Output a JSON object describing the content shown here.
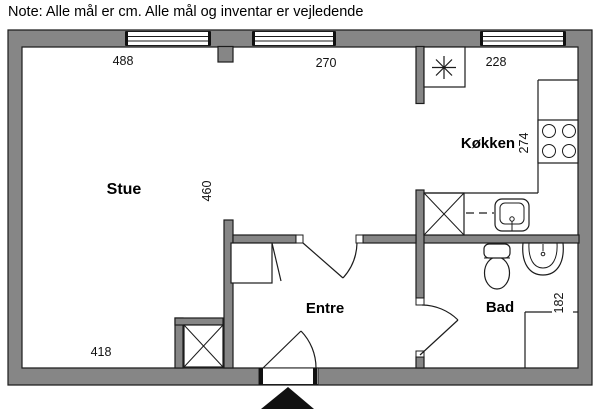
{
  "note": "Note: Alle mål er cm. Alle mål og inventar er vejledende",
  "rooms": {
    "stue": "Stue",
    "kokken": "Køkken",
    "entre": "Entre",
    "bad": "Bad"
  },
  "dimensions_cm": {
    "stue_top_width": "488",
    "mid_top_width": "270",
    "kokken_top_width": "228",
    "kokken_depth": "274",
    "stue_height": "460",
    "stue_bottom_width": "418",
    "bad_depth": "182"
  },
  "colors": {
    "wall_fill": "#868686",
    "line": "#1c1c1c",
    "background": "#ffffff",
    "entrance_marker": "#111111"
  },
  "fixtures": {
    "fridge": "star-box",
    "stove": "4-burner",
    "kitchen_sink": "single-basin",
    "toilet": "wc",
    "bath_sink": "round-basin",
    "shower": "corner-182",
    "cabinets": "cross-boxes"
  }
}
